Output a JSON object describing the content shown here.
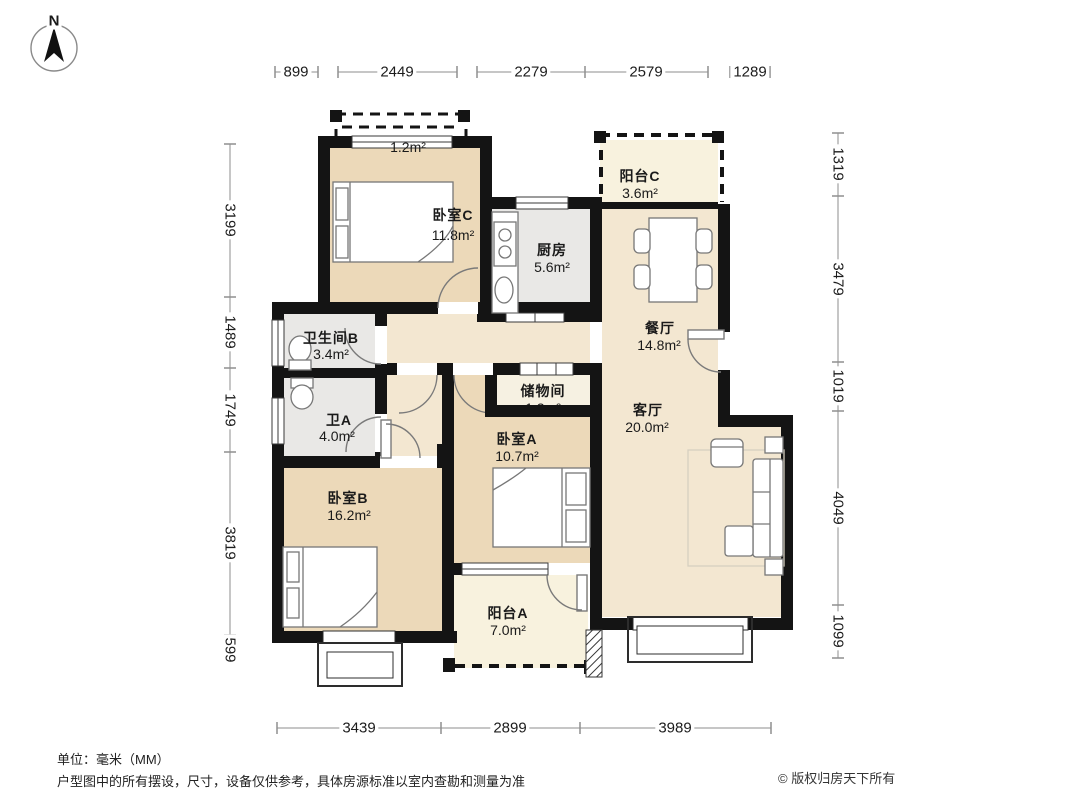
{
  "compass": {
    "north": "N"
  },
  "rooms": {
    "bedroom_c": {
      "label": "卧室C",
      "area": "11.8m²"
    },
    "kitchen": {
      "label": "厨房",
      "area": "5.6m²"
    },
    "balcony_c": {
      "label": "阳台C",
      "area": "3.6m²"
    },
    "dining": {
      "label": "餐厅",
      "area": "14.8m²"
    },
    "bath_b": {
      "label": "卫生间B",
      "area": "3.4m²"
    },
    "bath_a": {
      "label": "卫A",
      "area": "4.0m²"
    },
    "storage": {
      "label": "储物间",
      "area": "1.2m²"
    },
    "bedroom_a": {
      "label": "卧室A",
      "area": "10.7m²"
    },
    "living": {
      "label": "客厅",
      "area": "20.0m²"
    },
    "bedroom_b": {
      "label": "卧室B",
      "area": "16.2m²"
    },
    "balcony_a": {
      "label": "阳台A",
      "area": "7.0m²"
    },
    "bay_window": {
      "area": "1.2m²"
    }
  },
  "dimensions": {
    "top": [
      "899",
      "2449",
      "2279",
      "2579",
      "1289"
    ],
    "bottom": [
      "3439",
      "2899",
      "3989"
    ],
    "left": [
      "3199",
      "1489",
      "1749",
      "3819",
      "599"
    ],
    "right": [
      "1319",
      "3479",
      "1019",
      "4049",
      "1099"
    ]
  },
  "footer": {
    "unit": "单位：毫米（MM）",
    "disclaimer": "户型图中的所有摆设，尺寸，设备仅供参考，具体房源标准以室内查勘和测量为准",
    "copyright": "© 版权归房天下所有"
  },
  "colors": {
    "wall": "#141414",
    "bedroom_floor": "#ecd9b9",
    "public_floor": "#f3e7d1",
    "wet_floor": "#e9e8e6",
    "balcony_floor": "#f8f2de",
    "storage_floor": "#f6f1e2"
  }
}
